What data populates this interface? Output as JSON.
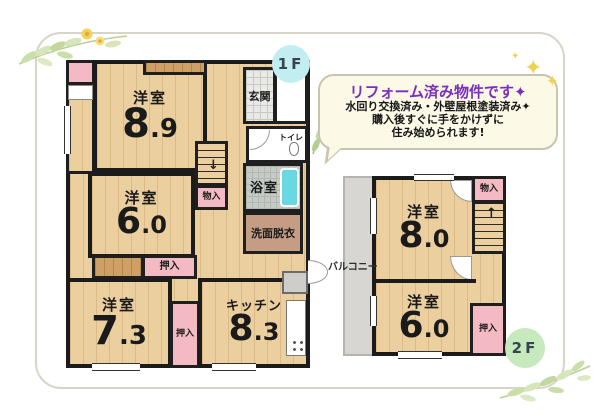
{
  "callout": {
    "title": "リフォーム済み物件です✦",
    "line1": "水回り交換済み・外壁屋根塗装済み✦",
    "line2": "購入後すぐに手をかけずに",
    "line3": "住み始められます!"
  },
  "badges": {
    "f1": "1F",
    "f2": "2F"
  },
  "floor1": {
    "rooms": {
      "yoshitsu_89": {
        "label": "洋室",
        "size_int": "8",
        "size_dec": ".9"
      },
      "yoshitsu_60": {
        "label": "洋室",
        "size_int": "6",
        "size_dec": ".0"
      },
      "yoshitsu_73": {
        "label": "洋室",
        "size_int": "7",
        "size_dec": ".3"
      },
      "kitchen": {
        "label": "キッチン",
        "size_int": "8",
        "size_dec": ".3"
      },
      "genkan": "玄関",
      "toilet": "トイレ",
      "bath": "浴室",
      "washroom": "洗面脱衣",
      "storage": "物入",
      "closet_a": "押入",
      "closet_b": "押入"
    }
  },
  "floor2": {
    "rooms": {
      "yoshitsu_80": {
        "label": "洋室",
        "size_int": "8",
        "size_dec": ".0"
      },
      "yoshitsu_60": {
        "label": "洋室",
        "size_int": "6",
        "size_dec": ".0"
      },
      "storage": "物入",
      "closet": "押入",
      "balcony": "バルコニー"
    }
  },
  "icons": {
    "sparkle": "✦",
    "stairs_down_arrow": "↓",
    "stairs_up_arrow": "↑"
  },
  "colors": {
    "accent_purple": "#7a2fc0",
    "badge_1f": "#c2eef2",
    "badge_2f": "#c6e9bd",
    "closet_pink": "#f4bac4",
    "bathtub": "#6ad8e2",
    "wood_floor": "#eccf9f"
  }
}
